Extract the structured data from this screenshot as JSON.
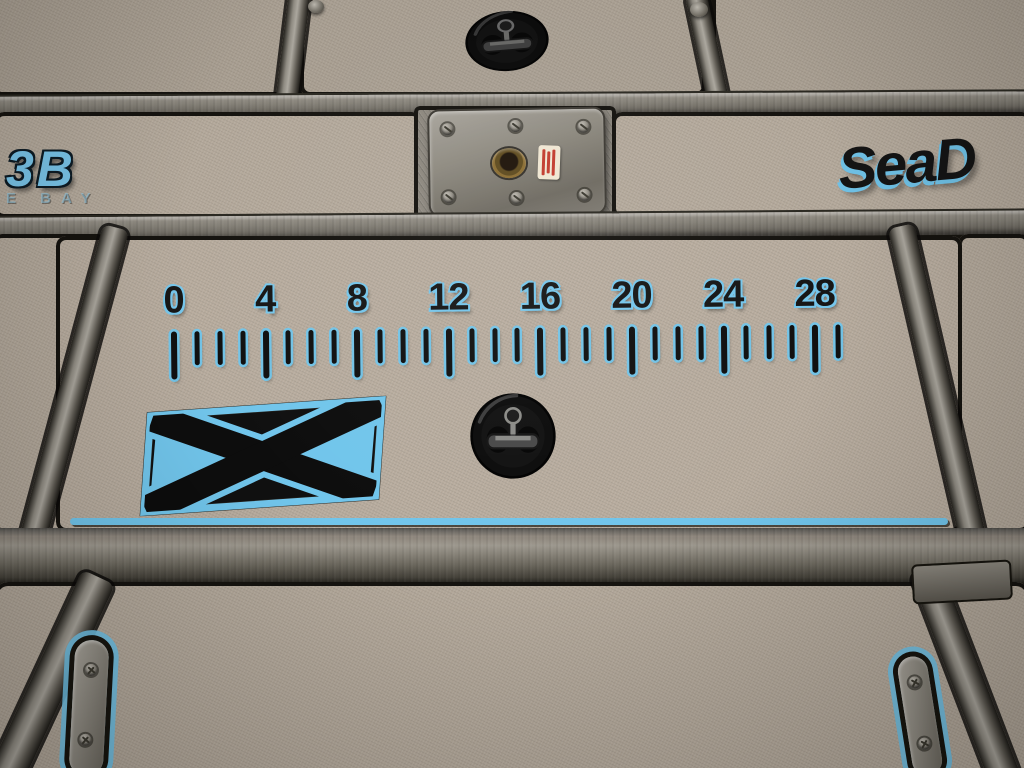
{
  "scene": {
    "subject": "boat deck with topographic foam pads, fish ruler, hatch latches and seat base plate"
  },
  "ruler": {
    "labels": [
      "0",
      "4",
      "8",
      "12",
      "16",
      "20",
      "24",
      "28"
    ],
    "tick_count": 30,
    "major_every": 4,
    "last_labeled_unit": 28,
    "unit_min": 0,
    "unit_max": 28
  },
  "logos": {
    "x_logo_letter": "X",
    "brand_partial": "SeaD"
  },
  "bay": {
    "label": "3B",
    "sublabel": "VE BAY"
  },
  "colors": {
    "foam_gray": "#b3a89a",
    "contour_blue": "#6fc1e6",
    "metal_gray": "#837f76",
    "recess_black": "#15130f",
    "brass": "#8a6c31",
    "sticker_red": "#c23b2e",
    "sticker_paper": "#efe6d2"
  },
  "icons": {
    "latch": "t-handle-latch-icon",
    "screw": "screw-icon",
    "hinge": "hinge-strip",
    "plate": "seat-base-plate"
  }
}
